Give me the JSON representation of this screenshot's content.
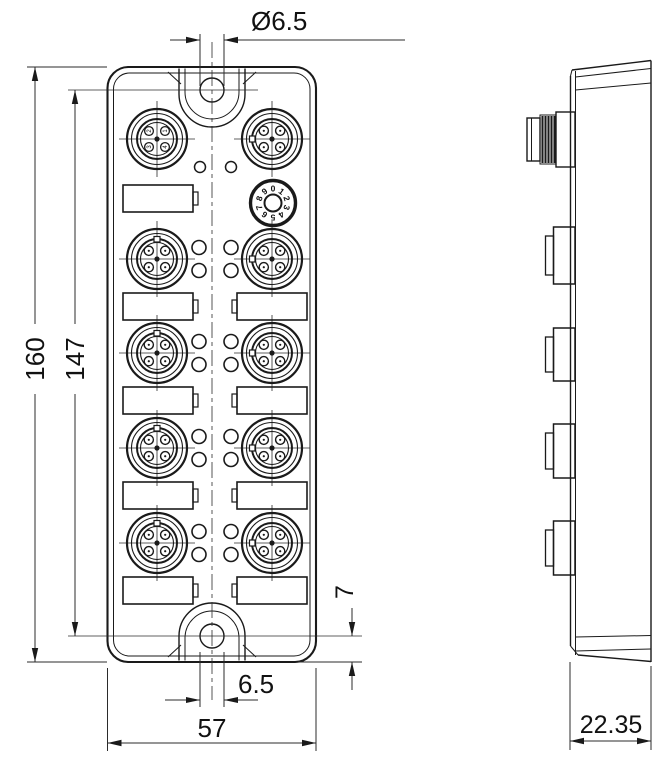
{
  "drawing": {
    "title": "I/O module dimensional drawing",
    "dimensions": {
      "mounting_hole_diameter": "Ø6.5",
      "overall_height": "160",
      "mounting_hole_spacing": "147",
      "overall_width": "57",
      "bottom_hole_width": "6.5",
      "bottom_hole_offset": "7",
      "overall_depth": "22.35"
    },
    "rotary_switch": {
      "digits": [
        "0",
        "1",
        "2",
        "3",
        "4",
        "5",
        "6",
        "7",
        "8",
        "9"
      ]
    },
    "power_connector_pins": [
      "2",
      "1",
      "3",
      "4"
    ],
    "line_color": "#1a1a1a",
    "background_color": "#ffffff"
  }
}
